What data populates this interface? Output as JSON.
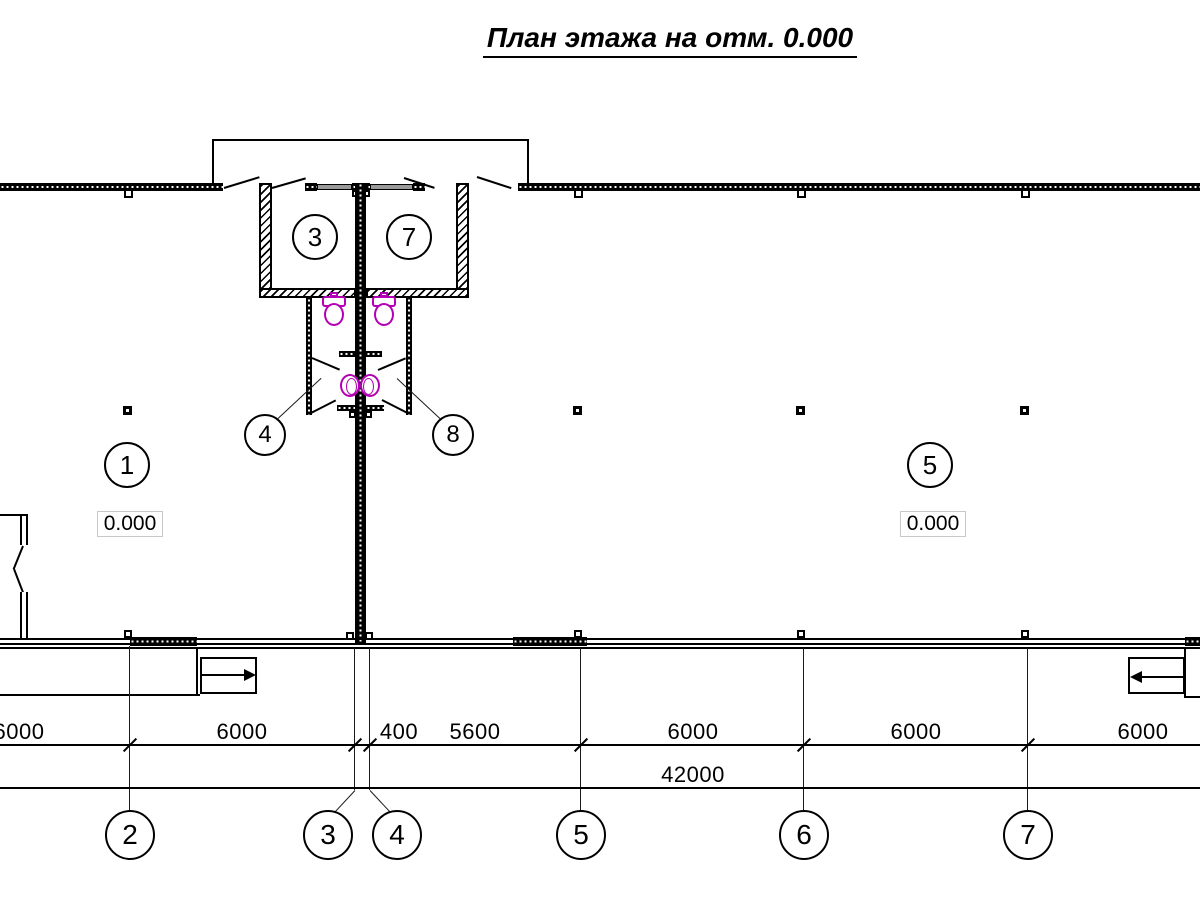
{
  "title": "План этажа на отм. 0.000",
  "rooms": {
    "vestibule_left": "3",
    "vestibule_right": "7",
    "wc_left": "4",
    "wc_right": "8",
    "hall_left": "1",
    "hall_right": "5",
    "hall_left_elevation": "0.000",
    "hall_right_elevation": "0.000"
  },
  "dimensions": {
    "bays": [
      "6000",
      "6000",
      "400",
      "5600",
      "6000",
      "6000",
      "6000"
    ],
    "total": "42000"
  },
  "axes": [
    "2",
    "3",
    "4",
    "5",
    "6",
    "7"
  ],
  "colors": {
    "line": "#000000",
    "fixture": "#b400b4",
    "door_leaf": "#9a9a9a",
    "elevation_box_border": "#c8c8c8"
  }
}
